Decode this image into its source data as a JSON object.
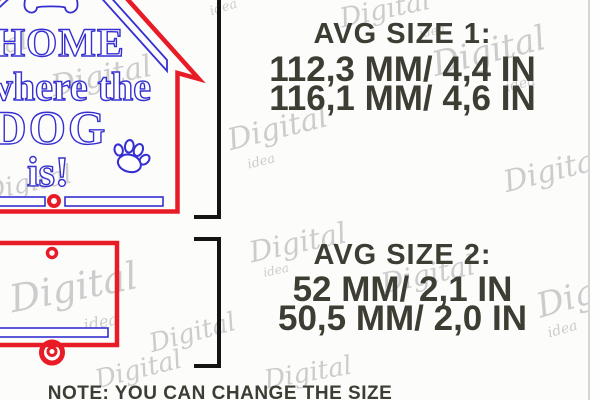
{
  "colors": {
    "bg": "#fcfcfb",
    "red": "#e81c26",
    "blue": "#3530cf",
    "dark": "#3d3d33",
    "black": "#141414",
    "watermark": "#c7c7c7",
    "divider": "#d6d6d6"
  },
  "sign": {
    "word1": "HOME",
    "word2": "where the",
    "word3": "DOG",
    "word4": "is!"
  },
  "size1": {
    "title": "AVG SIZE 1:",
    "line1": "112,3 MM/ 4,4 IN",
    "line2": "116,1 MM/ 4,6 IN"
  },
  "size2": {
    "title": "AVG SIZE 2:",
    "line1": "52 MM/ 2,1 IN",
    "line2": "50,5 MM/ 2,0 IN"
  },
  "note": "NOTE: YOU CAN CHANGE THE SIZE",
  "watermark": {
    "word": "Digital",
    "sub": "idea"
  }
}
